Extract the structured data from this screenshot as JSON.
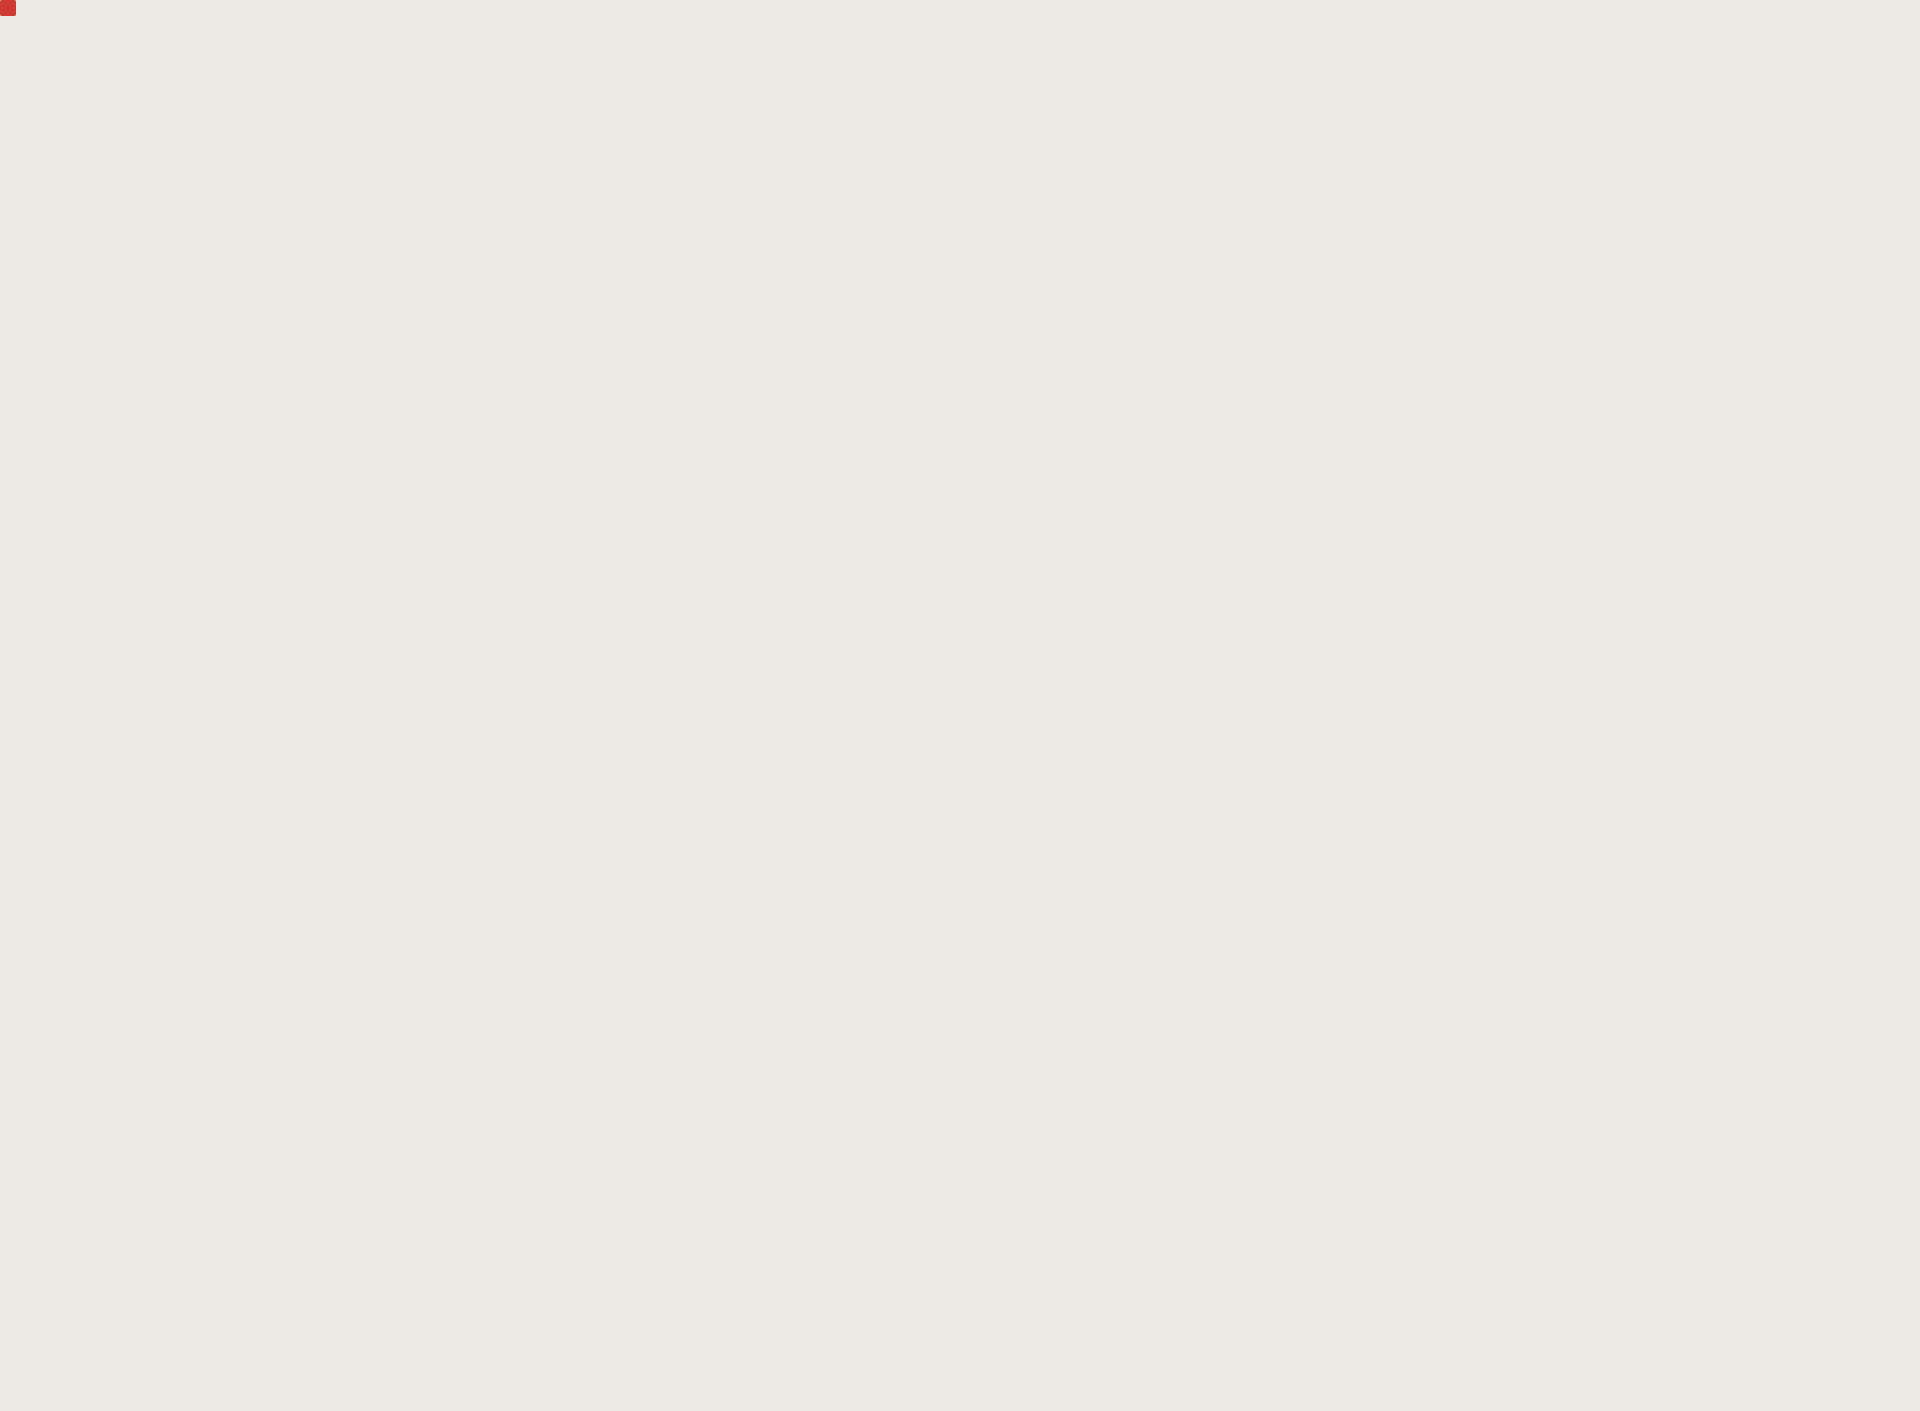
{
  "map": {
    "street_labels": [
      {
        "name": "granville-ave-1",
        "text": "Granville Ave",
        "style": "yellow",
        "x": 186,
        "y": 199,
        "rot": -3
      },
      {
        "name": "granville-ave-2",
        "text": "Granville Ave",
        "style": "yellow",
        "x": 742,
        "y": 200,
        "rot": -1
      },
      {
        "name": "granville-ave-3",
        "text": "Granville Ave",
        "style": "yellow",
        "x": 1591,
        "y": 204,
        "rot": -2
      },
      {
        "name": "garden-city-rd-upper",
        "text": "Garden City Rd",
        "style": "yellow",
        "x": 42,
        "y": 498,
        "rot": 88
      },
      {
        "name": "sills-ave-east",
        "text": "Sills Ave",
        "style": "yellow",
        "x": 1416,
        "y": 498,
        "rot": -4
      },
      {
        "name": "general-currie-rd-west",
        "text": "General Currie Rd",
        "style": "yellow",
        "x": 742,
        "y": 1133,
        "rot": -1
      },
      {
        "name": "general-currie-rd-east",
        "text": "General Currie Rd",
        "style": "yellow",
        "x": 1497,
        "y": 1121,
        "rot": -1
      },
      {
        "name": "armstrong-st",
        "text": "Armstrong St",
        "style": "yellow",
        "x": 1200,
        "y": 1088,
        "rot": 84
      },
      {
        "name": "no-4-rd-north",
        "text": "No 4 Rd",
        "style": "yellow",
        "x": 1897,
        "y": 420,
        "rot": 80
      },
      {
        "name": "garden-city-rd-top",
        "text": "Garden City Rd",
        "style": "gray",
        "x": 72,
        "y": 78,
        "rot": -53
      },
      {
        "name": "garden-city-rd-south",
        "text": "Garden City Rd",
        "style": "gray",
        "x": 45,
        "y": 1322,
        "rot": 88
      },
      {
        "name": "sills-ave-west",
        "text": "Sills Ave",
        "style": "gray",
        "x": 201,
        "y": 388,
        "rot": -2
      },
      {
        "name": "sills-ave-west-vertical",
        "text": "Sills Ave",
        "style": "gray",
        "x": 191,
        "y": 566,
        "rot": 88
      },
      {
        "name": "heather-st-mid",
        "text": "Heather St",
        "style": "gray",
        "x": 495,
        "y": 545,
        "rot": 88
      },
      {
        "name": "heather-st-south",
        "text": "Heather St",
        "style": "gray",
        "x": 494,
        "y": 1070,
        "rot": 88
      },
      {
        "name": "turnill-st-mid",
        "text": "Turnill St",
        "style": "gray",
        "x": 281,
        "y": 692,
        "rot": 88
      },
      {
        "name": "turnill-st-south",
        "text": "Turnill St",
        "style": "gray",
        "x": 206,
        "y": 1304,
        "rot": -3
      },
      {
        "name": "ash-st-mid",
        "text": "Ash St",
        "style": "gray",
        "x": 987,
        "y": 370,
        "rot": -3
      },
      {
        "name": "ash-st-south",
        "text": "Ash St",
        "style": "gray",
        "x": 966,
        "y": 1322,
        "rot": 88
      },
      {
        "name": "bridge-st-north",
        "text": "Bridge St",
        "style": "gray",
        "x": 1565,
        "y": 368,
        "rot": -4
      },
      {
        "name": "bridge-st-mid",
        "text": "Bridge St",
        "style": "gray",
        "x": 1420,
        "y": 632,
        "rot": 88
      },
      {
        "name": "bridge-st-south",
        "text": "Bridge St",
        "style": "gray",
        "x": 1400,
        "y": 1327,
        "rot": 86
      },
      {
        "name": "lechow-st",
        "text": "Lechow St",
        "style": "gray",
        "x": 1636,
        "y": 700,
        "rot": 86
      },
      {
        "name": "shields-ave",
        "text": "Shields Ave",
        "style": "gray",
        "x": 1527,
        "y": 935,
        "rot": -2
      },
      {
        "name": "no-4-rd-south",
        "text": "No 4 Rd",
        "style": "gray",
        "x": 1783,
        "y": 1325,
        "rot": 84
      },
      {
        "name": "ave-fragment",
        "text": "ve",
        "style": "gray",
        "x": 16,
        "y": 222,
        "rot": -10
      }
    ],
    "area_label": {
      "line1": "MCLENNAN",
      "line2": "SOUTH",
      "x": 900,
      "y": 1130
    },
    "highlight": {
      "x": 1202,
      "y": 575,
      "width": 84,
      "height": 277,
      "color": "#ce3b33",
      "lot_count": 10
    },
    "palette": {
      "background": "#eceae4",
      "street": "#fcfcf9",
      "parcel_line": "#151515",
      "building_outline": "#c9a558",
      "building_fill": "#efe8d8",
      "park_green": "#a9c28f",
      "park_green_light": "#c6dbae",
      "label_gray": "#7c828c",
      "area_label_gray": "#8e939a",
      "label_highlight_bg": "#f2e205",
      "label_highlight_text": "#5d5f35",
      "highlight_red": "#ce3b33"
    }
  }
}
